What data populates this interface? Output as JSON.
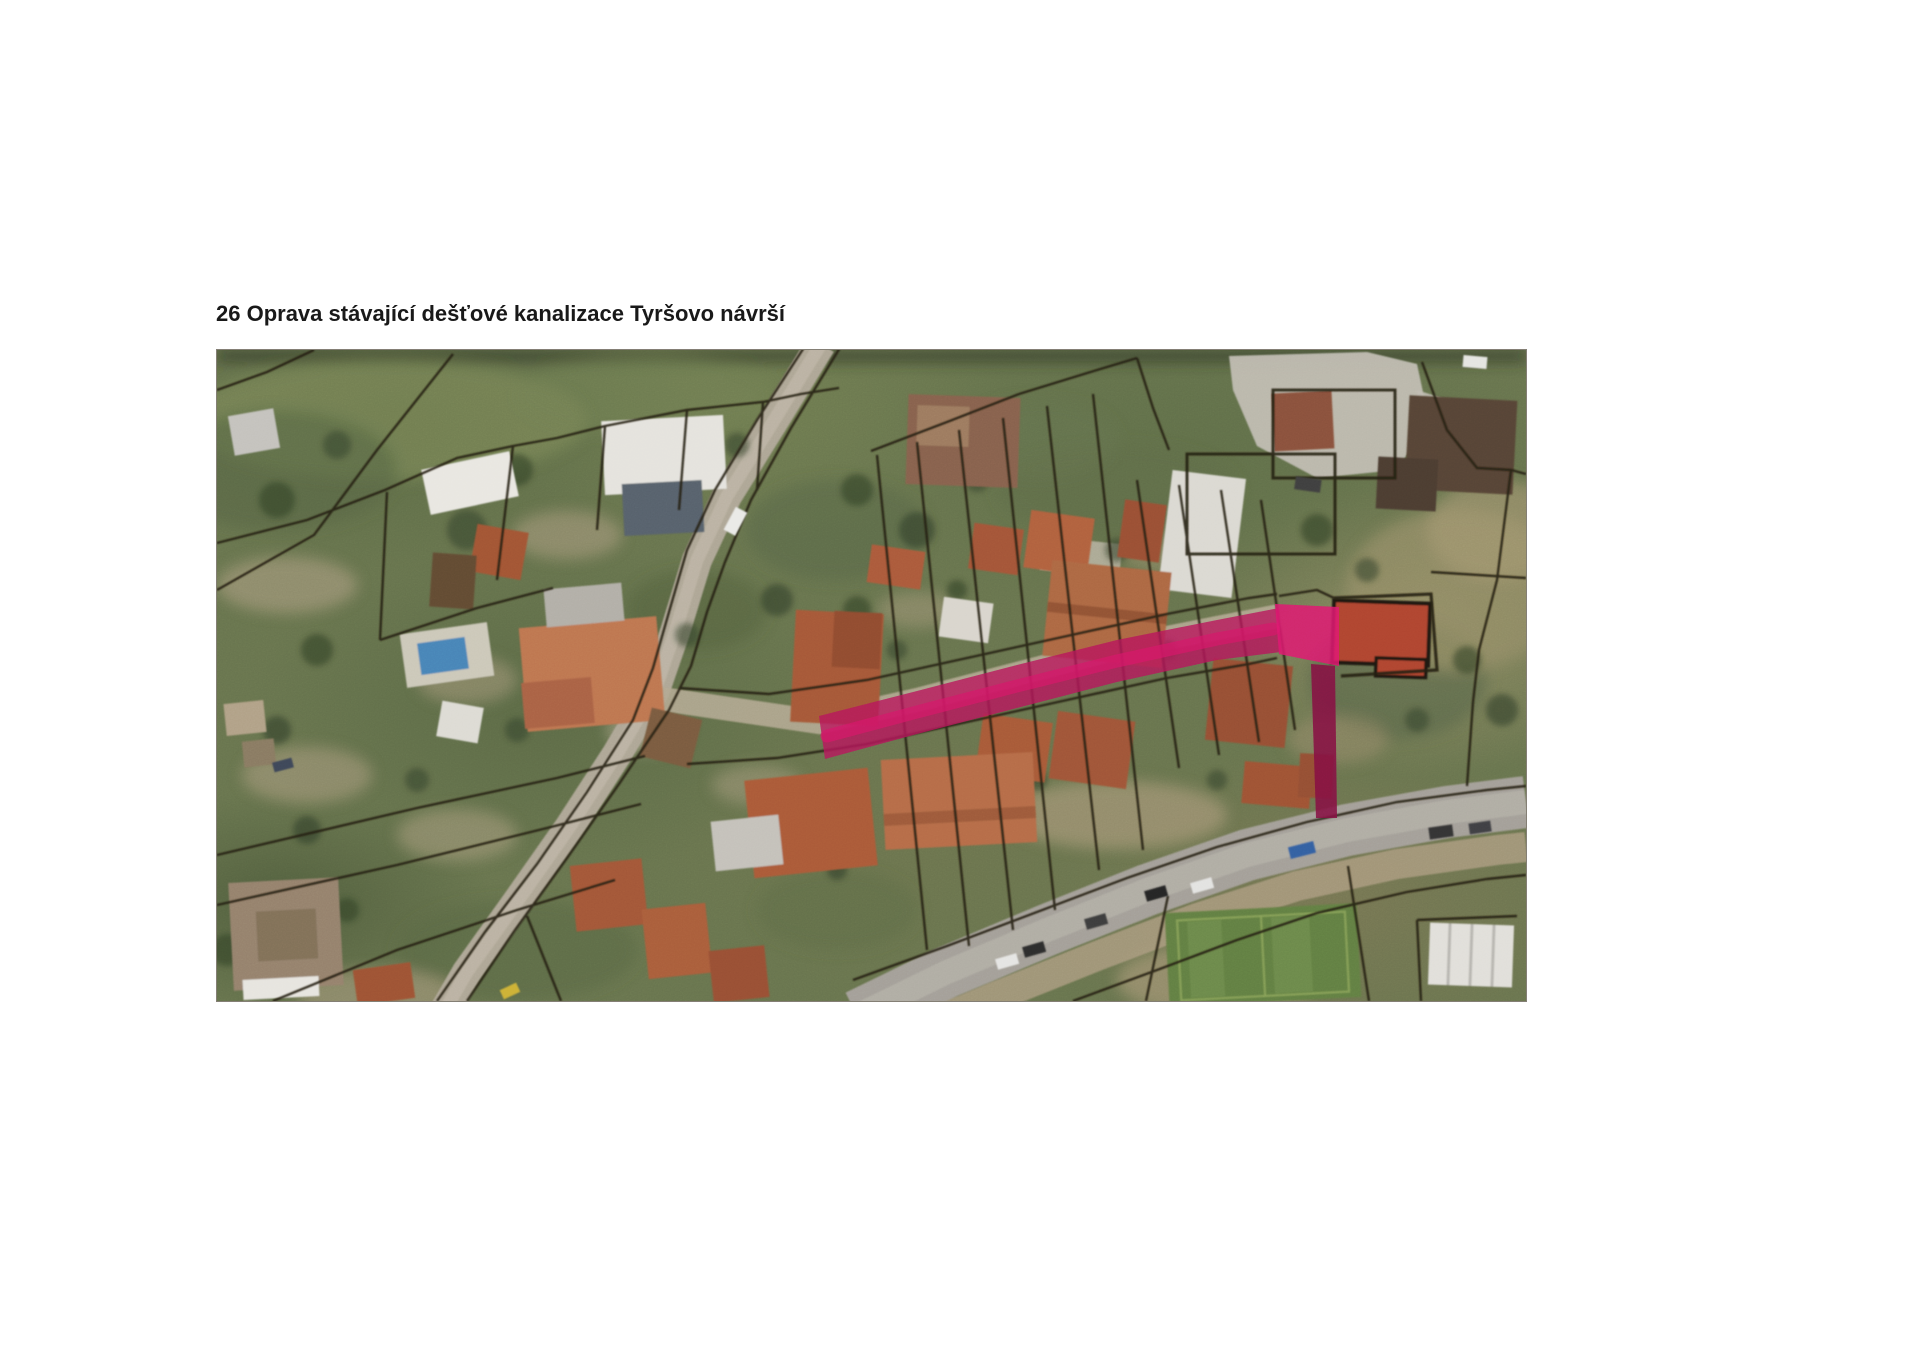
{
  "page": {
    "title": "26 Oprava stávající dešťové kanalizace Tyršovo návrší"
  },
  "map": {
    "type": "aerial-orthophoto-figure",
    "highlight": {
      "semantic": "storm-drainage-route-highlight",
      "band_color": "#c30f5c",
      "accent_color": "#ee1273",
      "drop_color": "#8c0a42"
    }
  }
}
